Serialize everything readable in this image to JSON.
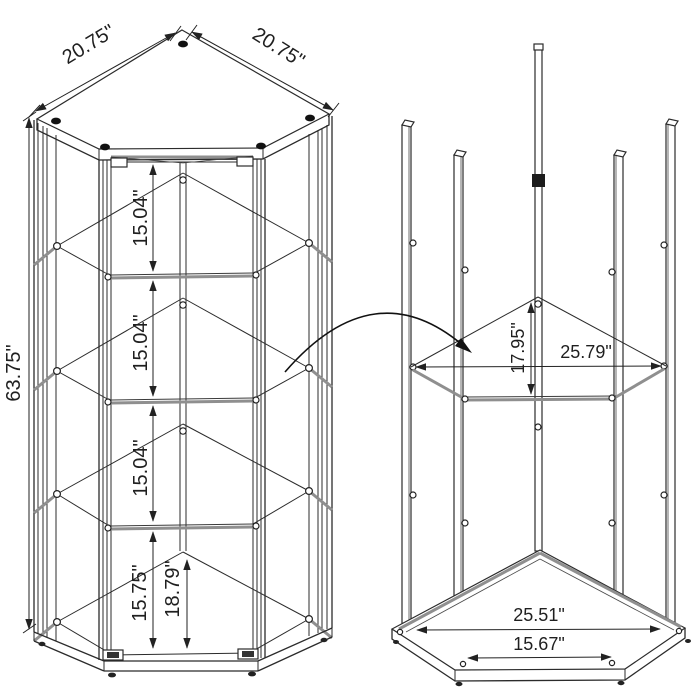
{
  "colors": {
    "background": "#ffffff",
    "line": "#2b2b2b",
    "glass_edge": "#8f8f8f",
    "text": "#1f1f1f"
  },
  "views": {
    "assembled": {
      "name": "corner-curio-cabinet-assembled",
      "labels": {
        "top_edge_left": "20.75\"",
        "top_edge_right": "20.75\"",
        "overall_height": "63.75\"",
        "gap_top": "15.04\"",
        "gap_middle": "15.04\"",
        "gap_lower": "15.04\"",
        "gap_bottom_front": "15.75\"",
        "gap_bottom_back": "18.79\""
      }
    },
    "frame": {
      "name": "frame-shelf-installation",
      "labels": {
        "shelf_depth": "17.95\"",
        "shelf_span": "25.79\"",
        "base_span_outer": "25.51\"",
        "base_span_inner": "15.67\""
      }
    }
  }
}
